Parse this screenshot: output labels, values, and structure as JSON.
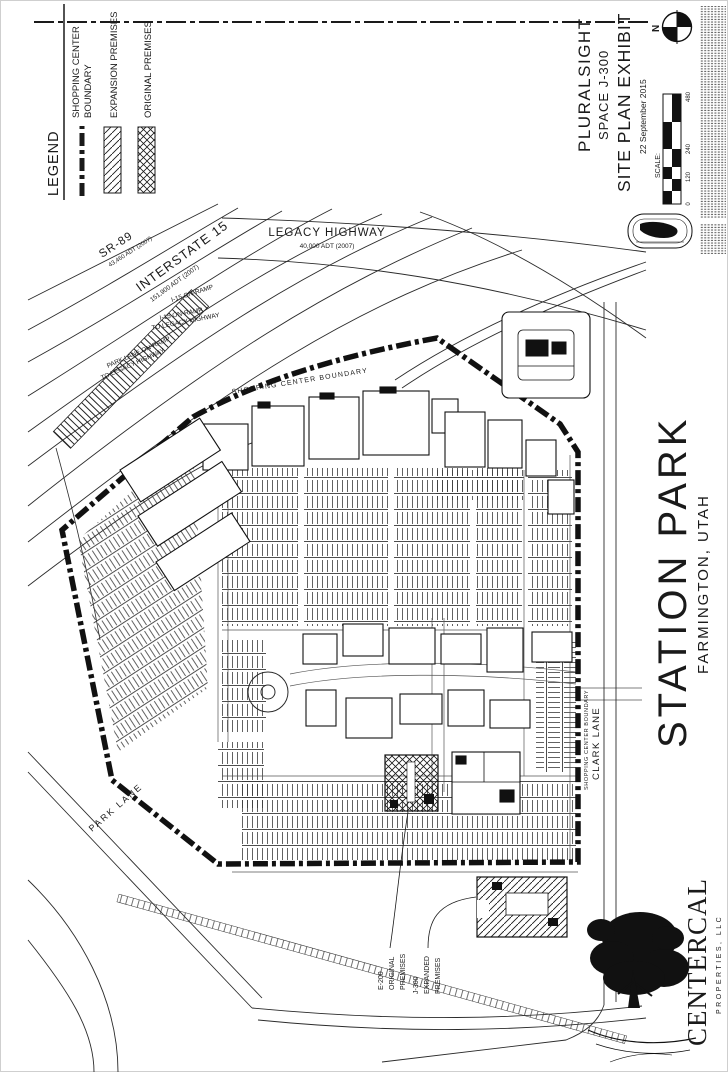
{
  "legend": {
    "title": "LEGEND",
    "boundary_line1": "SHOPPING CENTER",
    "boundary_line2": "BOUNDARY",
    "expansion": "EXPANSION PREMISES",
    "original": "ORIGINAL PREMISES"
  },
  "title_block": {
    "client": "PLURALSIGHT",
    "space": "SPACE J-300",
    "title": "SITE PLAN EXHIBIT",
    "date": "22 September 2015",
    "scale_label": "SCALE:",
    "north_label": "N",
    "scale_ticks": {
      "t0": "0",
      "t1": "120",
      "t2": "240",
      "t3": "480"
    }
  },
  "project": {
    "name": "STATION PARK",
    "location": "FARMINGTON, UTAH"
  },
  "firm": {
    "name": "CENTERCAL",
    "subtitle": "PROPERTIES, LLC"
  },
  "map": {
    "labels": {
      "legacy": "LEGACY HIGHWAY",
      "legacy_adt": "40,000 ADT (2007)",
      "i15": "INTERSTATE 15",
      "i15_adt": "151,900 ADT (2007)",
      "sr89": "SR-89",
      "sr89_adt": "43,460 ADT (2007)",
      "ramp_i15": "I-15 ON-RAMP",
      "ramp_i15_legacy_1": "I-15 ON-RAMP",
      "ramp_i15_legacy_2": "TO LEGACY HIGHWAY",
      "ramp_parklane_1": "PARK LANE ON-RAMP",
      "ramp_parklane_2": "TO LEGACY HIGHWAY",
      "boundary_top": "SHOPPING CENTER BOUNDARY",
      "boundary_right": "SHOPPING CENTER BOUNDARY",
      "clark_lane": "CLARK LANE",
      "park_lane": "PARK LANE",
      "e200_1": "E-200",
      "e200_2": "ORIGINAL",
      "e200_3": "PREMISES",
      "j300_1": "J-300",
      "j300_2": "EXPANDED",
      "j300_3": "PREMISES"
    }
  }
}
